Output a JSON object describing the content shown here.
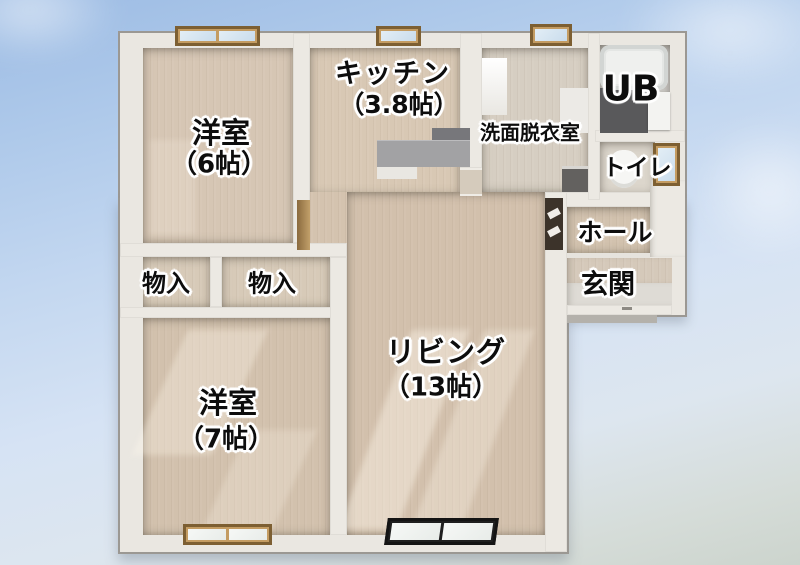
{
  "scene": {
    "type": "3d-floor-plan",
    "description": "Japanese apartment 2LDK floor plan, top-down 3D render on sky background"
  },
  "rooms": {
    "bedroom6": {
      "name": "洋室",
      "size": "（6帖）"
    },
    "kitchen": {
      "name": "キッチン",
      "size": "（3.8帖）"
    },
    "washroom": {
      "name": "洗面脱衣室"
    },
    "unit_bath": {
      "name": "UB"
    },
    "toilet": {
      "name": "トイレ"
    },
    "hall": {
      "name": "ホール"
    },
    "entrance": {
      "name": "玄関"
    },
    "storage_left": {
      "name": "物入"
    },
    "storage_right": {
      "name": "物入"
    },
    "living": {
      "name": "リビング",
      "size": "（13帖）"
    },
    "bedroom7": {
      "name": "洋室",
      "size": "（7帖）"
    }
  },
  "palette": {
    "sky_top": "#9dbce4",
    "sky_bottom": "#ccd4cd",
    "wall": "#eae7e1",
    "wall_outline": "#9b9893",
    "floor_wood": "#d3c2ae",
    "floor_washroom": "#d6cec2",
    "counter_gray": "#a2a2a4",
    "bath_floor_dark": "#59595b",
    "door_dark_brown": "#3c332a",
    "window_glass_blue": "#cfdfee",
    "window_frame_wood": "#c49c62",
    "window_frame_black": "#1f1f1f",
    "label_text": "#0d0d0d",
    "label_halo": "#ffffff"
  }
}
